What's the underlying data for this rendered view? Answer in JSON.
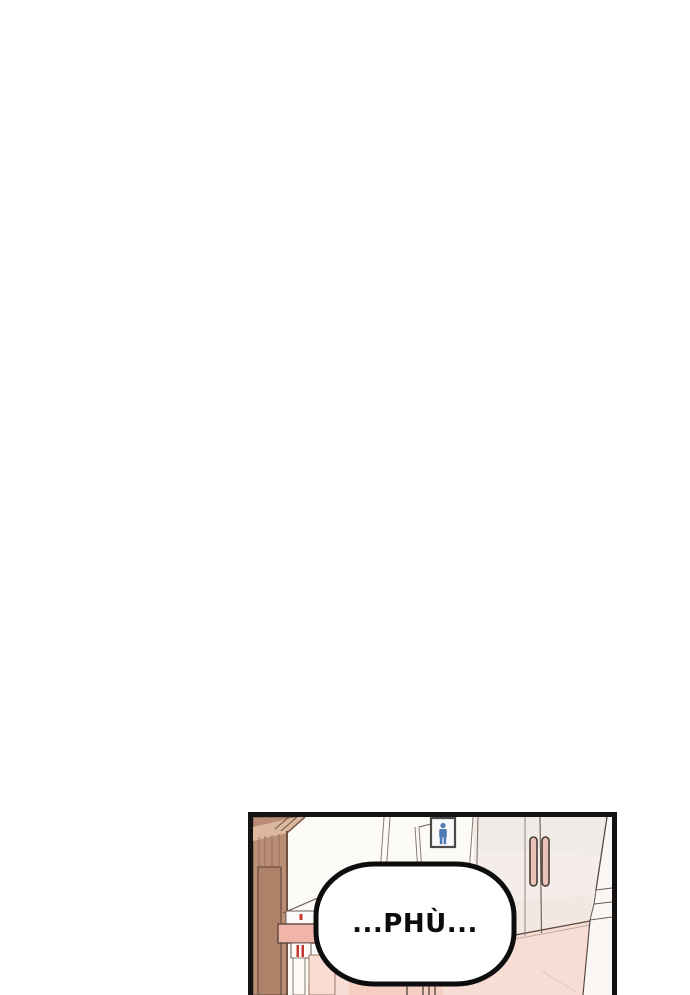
{
  "page": {
    "background": "#ffffff",
    "kind": "webtoon-strip-segment"
  },
  "panel": {
    "border_color": "#141414",
    "speech_bubble": {
      "text": "...PHÙ...",
      "fill": "#ffffff",
      "stroke": "#0d0d0d"
    },
    "restroom_sign": {
      "icon": "male-restroom-pictogram",
      "figure_color": "#4d7ab5",
      "frame_color": "#4a4a4a",
      "fill": "#fbfafa"
    },
    "colors": {
      "wood": "#b98e75",
      "wood_light": "#dbb89e",
      "wood_inset": "#ae8269",
      "wood_dark": "#6f5242",
      "wall": "#fdfbf8",
      "door": "#f4ede9",
      "door_upper_tint": "#efe9e5",
      "door_lower_tint": "#f3e2dc",
      "handle": "#e9c3b8",
      "floor": "#f8ddd5",
      "floor_band": "#f6cfc2",
      "beam": "#f0b5a8",
      "board": "#f8dcd2",
      "red_mark": "#c0392b",
      "corner_wall": "#faf7f4"
    }
  }
}
